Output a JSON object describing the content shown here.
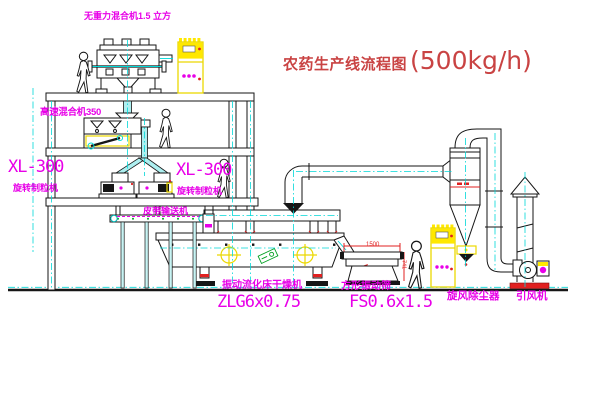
{
  "title": {
    "text": "农药生产线流程图",
    "capacity": "(500kg/h)"
  },
  "labels": {
    "zero_gravity_mixer": "无重力混合机1.5 立方",
    "high_speed_mixer": "高速混合机350",
    "granulator_left": {
      "model": "XL-300",
      "name": "旋转制粒机"
    },
    "granulator_right": {
      "model": "XL-300",
      "name": "旋转制粒机"
    },
    "belt_conveyor": "皮带输送机",
    "fluid_bed_dryer": {
      "name": "振动流化床干燥机",
      "model": "ZLG6x0.75"
    },
    "vibrating_screen": {
      "name": "方形振动筛",
      "model": "FS0.6x1.5"
    },
    "cyclone": "旋风除尘器",
    "induced_draft_fan": "引风机"
  },
  "dimensions": {
    "screen_length": "1500",
    "screen_height": "741"
  },
  "colors": {
    "label_magenta": "#e800e8",
    "title_red": "#c94343",
    "centerline_cyan": "#00d8d8",
    "cabinet_yellow": "#ffe800",
    "dimension_red": "#e02020",
    "tag_green": "#00a020"
  }
}
